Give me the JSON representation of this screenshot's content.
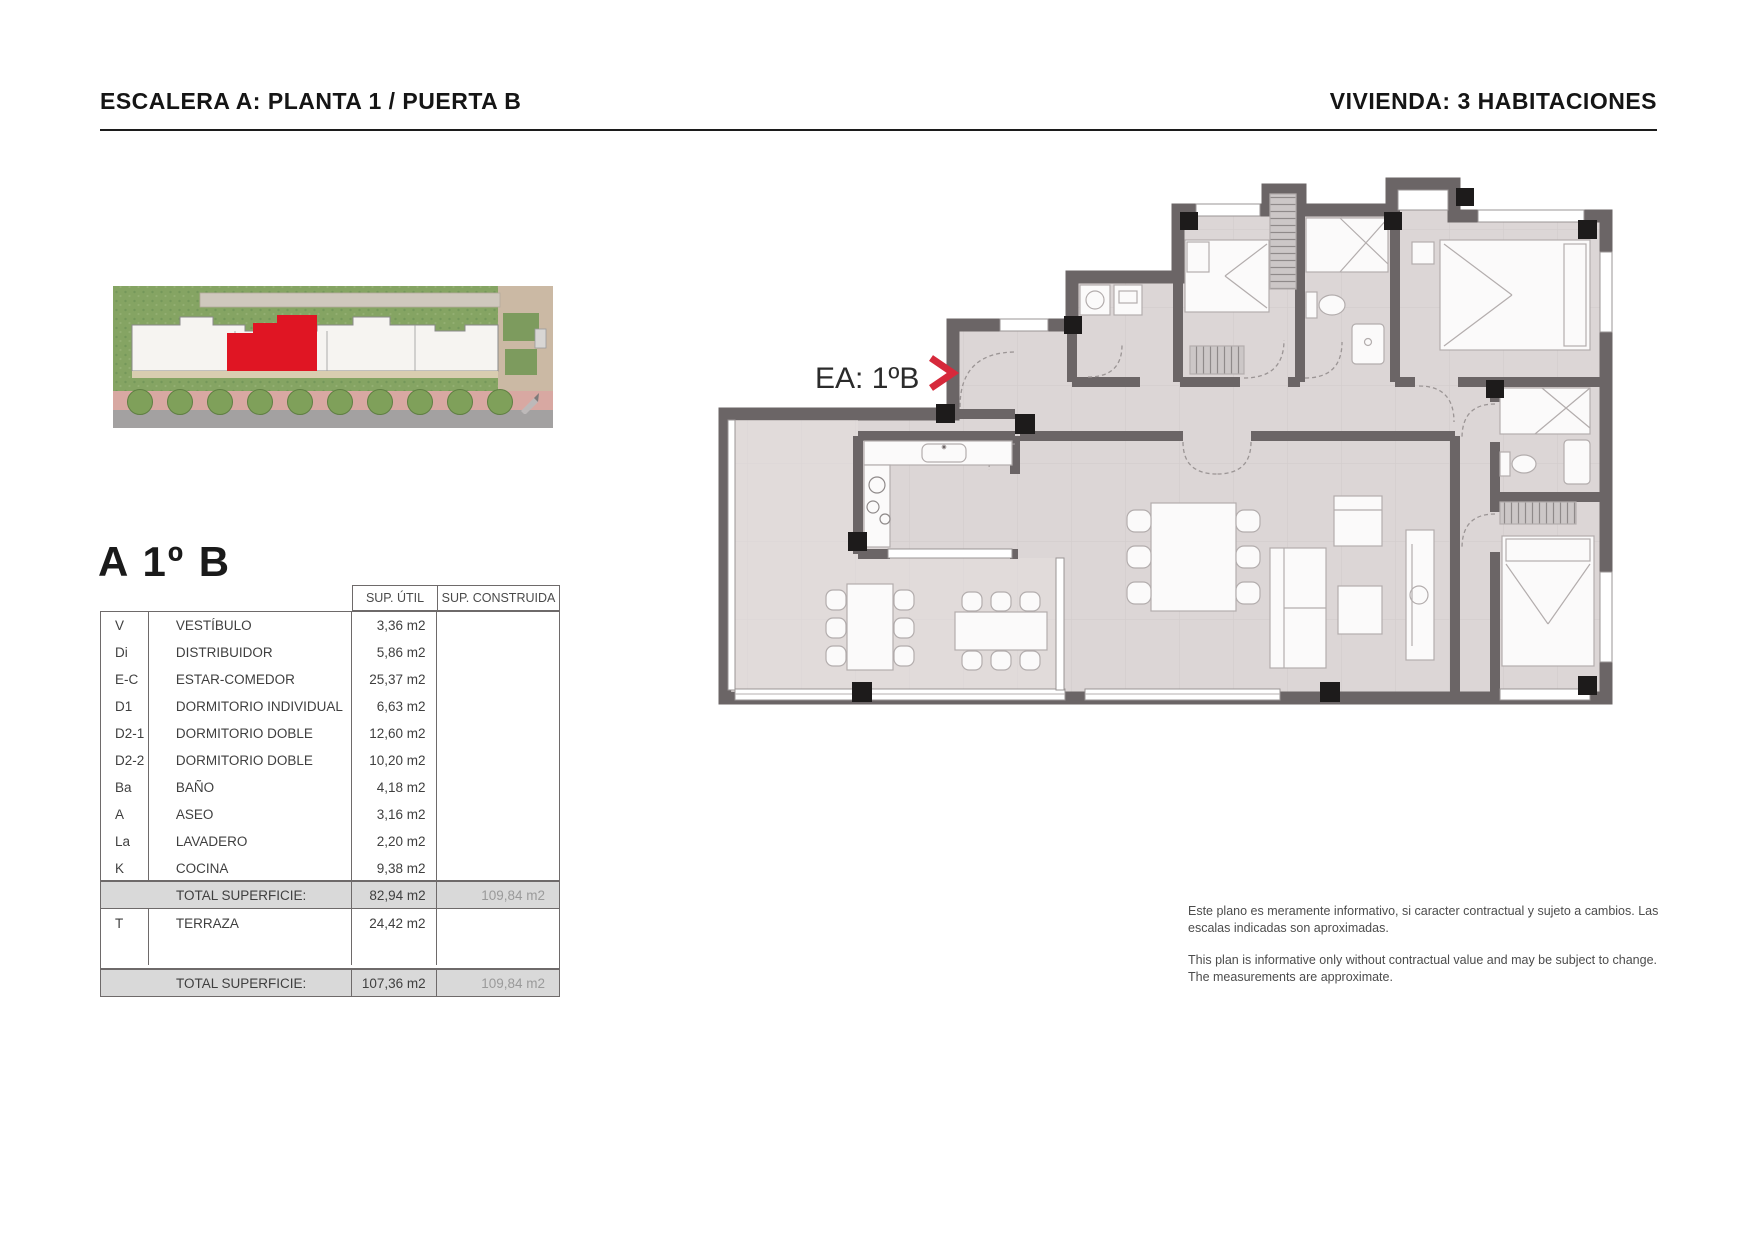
{
  "header": {
    "left_title": "ESCALERA A: PLANTA 1 / PUERTA B",
    "right_title": "VIVIENDA: 3 HABITACIONES"
  },
  "unit_title": "A 1º B",
  "plan": {
    "label": "EA: 1ºB",
    "chevron": ">",
    "scale_labels": [
      "0",
      "0.5",
      "1",
      "2",
      "3"
    ]
  },
  "table": {
    "headers": {
      "util": "SUP. ÚTIL",
      "constr": "SUP. CONSTRUIDA"
    },
    "rows": [
      {
        "code": "V",
        "name": "VESTÍBULO",
        "util": "3,36 m2",
        "constr": ""
      },
      {
        "code": "Di",
        "name": "DISTRIBUIDOR",
        "util": "5,86 m2",
        "constr": ""
      },
      {
        "code": "E-C",
        "name": "ESTAR-COMEDOR",
        "util": "25,37 m2",
        "constr": ""
      },
      {
        "code": "D1",
        "name": "DORMITORIO INDIVIDUAL",
        "util": "6,63 m2",
        "constr": ""
      },
      {
        "code": "D2-1",
        "name": "DORMITORIO DOBLE",
        "util": "12,60 m2",
        "constr": ""
      },
      {
        "code": "D2-2",
        "name": "DORMITORIO DOBLE",
        "util": "10,20 m2",
        "constr": ""
      },
      {
        "code": "Ba",
        "name": "BAÑO",
        "util": "4,18 m2",
        "constr": ""
      },
      {
        "code": "A",
        "name": "ASEO",
        "util": "3,16 m2",
        "constr": ""
      },
      {
        "code": "La",
        "name": "LAVADERO",
        "util": "2,20 m2",
        "constr": ""
      },
      {
        "code": "K",
        "name": "COCINA",
        "util": "9,38 m2",
        "constr": ""
      }
    ],
    "total_1": {
      "label": "TOTAL SUPERFICIE:",
      "util": "82,94 m2",
      "constr": "109,84 m2"
    },
    "terrace_row": {
      "code": "T",
      "name": "TERRAZA",
      "util": "24,42 m2",
      "constr": ""
    },
    "total_2": {
      "label": "TOTAL SUPERFICIE:",
      "util": "107,36 m2",
      "constr": "109,84 m2"
    }
  },
  "disclaimer": {
    "es": "Este plano es meramente informativo, si caracter contractual y sujeto a cambios. Las escalas indicadas son aproximadas.",
    "en": "This plan is informative only without contractual value and may be subject to change. The measurements are approximate."
  },
  "colors": {
    "accent_red": "#d6293b",
    "site_red": "#e01523",
    "wall": "#6b6566",
    "floor": "#dcd6d6",
    "total_row_bg": "#d9d9d9",
    "grass": "#85a463",
    "sidewalk_pink": "#d8a8a2",
    "road_gray": "#a3a1a1"
  }
}
